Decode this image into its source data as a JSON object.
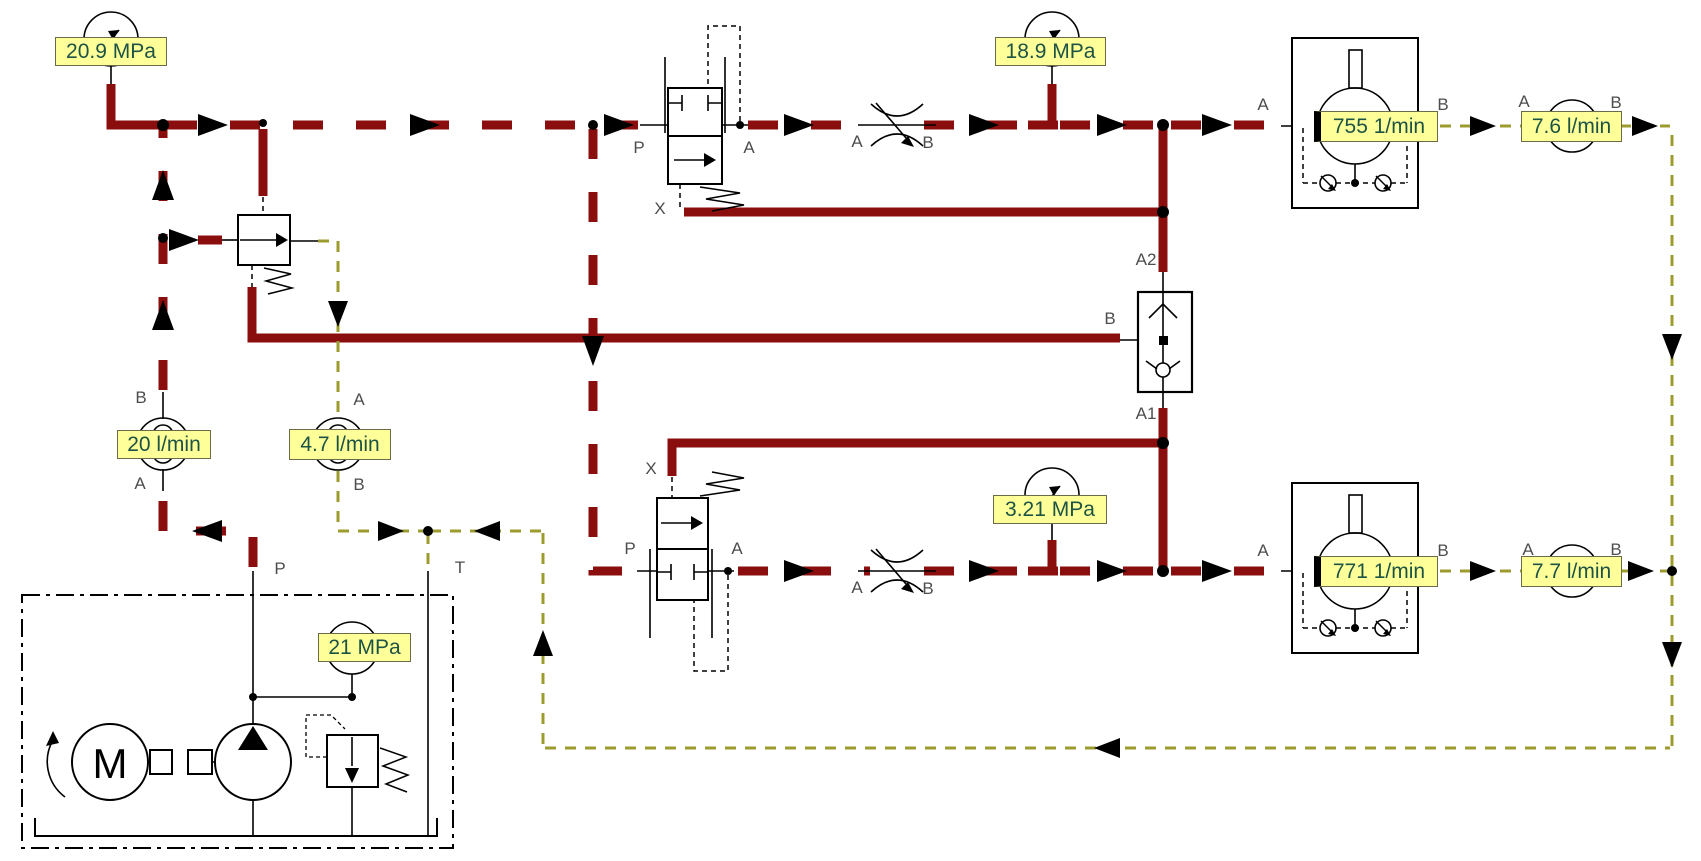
{
  "diagram_type": "hydraulic-circuit-simulation",
  "colors": {
    "pressure_line": "#8b0e0e",
    "drain_pilot_line": "#9c9c2e",
    "label_background": "#ffff99",
    "label_text": "#1d5345",
    "port_text": "#4d4d4d"
  },
  "readings": {
    "pump_line_pressure": "20.9 MPa",
    "top_motor_inlet_pressure": "18.9 MPa",
    "bottom_motor_inlet_pressure": "3.21 MPa",
    "power_unit_pressure": "21 MPa",
    "pump_flow": "20 l/min",
    "reducer_drain_flow": "4.7 l/min",
    "top_motor_speed": "755 1/min",
    "top_motor_drain_flow": "7.6 l/min",
    "bottom_motor_speed": "771 1/min",
    "bottom_motor_drain_flow": "7.7 l/min"
  },
  "ports": {
    "pump_meter_top": "B",
    "pump_meter_bottom": "A",
    "drain_meter_top": "A",
    "drain_meter_bottom": "B",
    "top_valve_p": "P",
    "top_valve_a": "A",
    "top_valve_x": "X",
    "top_throttle_a": "A",
    "top_throttle_b": "B",
    "top_motor_a": "A",
    "top_motor_b": "B",
    "top_drain_meter_a": "A",
    "top_drain_meter_b": "B",
    "shuttle_a2": "A2",
    "shuttle_b": "B",
    "shuttle_a1": "A1",
    "bottom_valve_x": "X",
    "bottom_valve_p": "P",
    "bottom_valve_a": "A",
    "bottom_throttle_a": "A",
    "bottom_throttle_b": "B",
    "bottom_motor_a": "A",
    "bottom_motor_b": "B",
    "bottom_drain_meter_a": "A",
    "bottom_drain_meter_b": "B",
    "power_unit_p": "P",
    "power_unit_t": "T"
  },
  "power_unit": {
    "motor_letter": "M"
  }
}
